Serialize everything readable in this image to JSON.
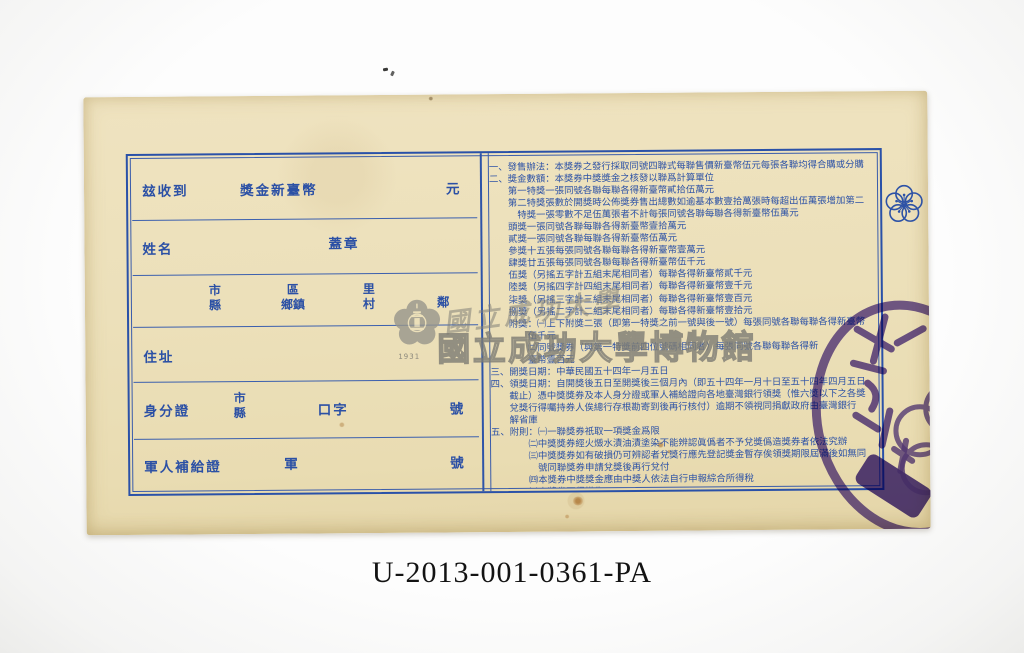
{
  "colors": {
    "paper": "#ece0ba",
    "print_blue": "#2d52a6",
    "stamp_purple": "#4a2d99",
    "watermark_gray": "#8f8e86"
  },
  "form": {
    "received_label": "玆收到",
    "amount_prefix": "獎金新臺幣",
    "amount_unit": "元",
    "name_label": "姓名",
    "seal_label": "蓋章",
    "address_units": {
      "city": "市",
      "county": "縣",
      "district": "區",
      "township": "鄉鎮",
      "li": "里",
      "village": "村",
      "neighborhood": "鄰"
    },
    "address_label": "住址",
    "id_label": "身分證",
    "id_city": "市",
    "id_county": "縣",
    "id_word": "口字",
    "id_number_suffix": "號",
    "military_label": "軍人補給證",
    "military_word": "軍",
    "military_number_suffix": "號"
  },
  "terms": {
    "lines": [
      "一、發售辦法：本獎券之發行採取同號四聯式每聯售價新臺幣伍元每張各聯均得合購或分購",
      "二、獎金數額：本獎券中獎獎金之核發以聯爲計算單位",
      "　　第一特獎一張同號各聯每聯各得新臺幣貳拾伍萬元",
      "　　第二特獎張數於開獎時公佈獎券售出總數如逾基本數壹拾萬張時每超出伍萬張增加第二",
      "　　　特獎一張零數不足伍萬張者不計每張同號各聯每聯各得新臺幣伍萬元",
      "　　頭獎一張同號各聯每聯各得新臺幣壹拾萬元",
      "　　貳獎一張同號各聯每聯各得新臺幣伍萬元",
      "　　參獎十五張每張同號各聯每聯各得新臺幣壹萬元",
      "　　肆獎廿五張每張同號各聯每聯各得新臺幣伍千元",
      "　　伍獎（另搖五字計五組末尾相同者）每聯各得新臺幣貳千元",
      "　　陸獎（另搖四字計四組末尾相同者）每聯各得新臺幣壹千元",
      "　　柒獎（另搖三字計三組末尾相同者）每聯各得新臺幣壹百元",
      "　　捌獎（另搖二字計二組末尾相同者）每聯各得新臺幣壹拾元",
      "　　附獎：㈠上下附獎二張（即第一特獎之前一號與後一號）每張同號各聯每聯各得新臺幣",
      "　　　　伍千元",
      "　　　　㈡同號獎券（與第一特獎前四位號碼相同者）每張同號各聯每聯各得新",
      "　　　　臺幣壹百元",
      "三、開獎日期：中華民國五十四年一月五日",
      "四、領獎日期：自開獎後五日至開獎後三個月內（即五十四年一月十日至五十四年四月五日",
      "　　截止）憑中獎獎券及本人身分證或軍人補給證向各地臺灣銀行領獎（惟六獎以下之各獎",
      "　　兌獎行得囑持券人俟總行存根勘寄到後再行核付）逾期不領視同捐獻政府由臺灣銀行",
      "　　解省庫",
      "五、附則：㈠一聯獎券祇取一項獎金爲限",
      "　　　　㈡中獎獎券經火燬水漬油漬塗染不能辨認眞僞者不予兌獎僞造獎券者依法究辦",
      "　　　　㈢中獎獎券如有破損仍可辨認者兌獎行應先登記獎金暫存俟領獎期限屆滿後如無同",
      "　　　　　號同聯獎券申請兌獎後再行兌付",
      "　　　　㈣本獎券中獎獎金應由中獎人依法自行申報綜合所得稅",
      "　　　　㈤本獎券不得掛失"
    ]
  },
  "watermark": {
    "script_text": "國立成功大學",
    "museum_text": "國立成功大學博物館",
    "seal_year": "1931"
  },
  "caption": "U-2013-001-0361-PA"
}
